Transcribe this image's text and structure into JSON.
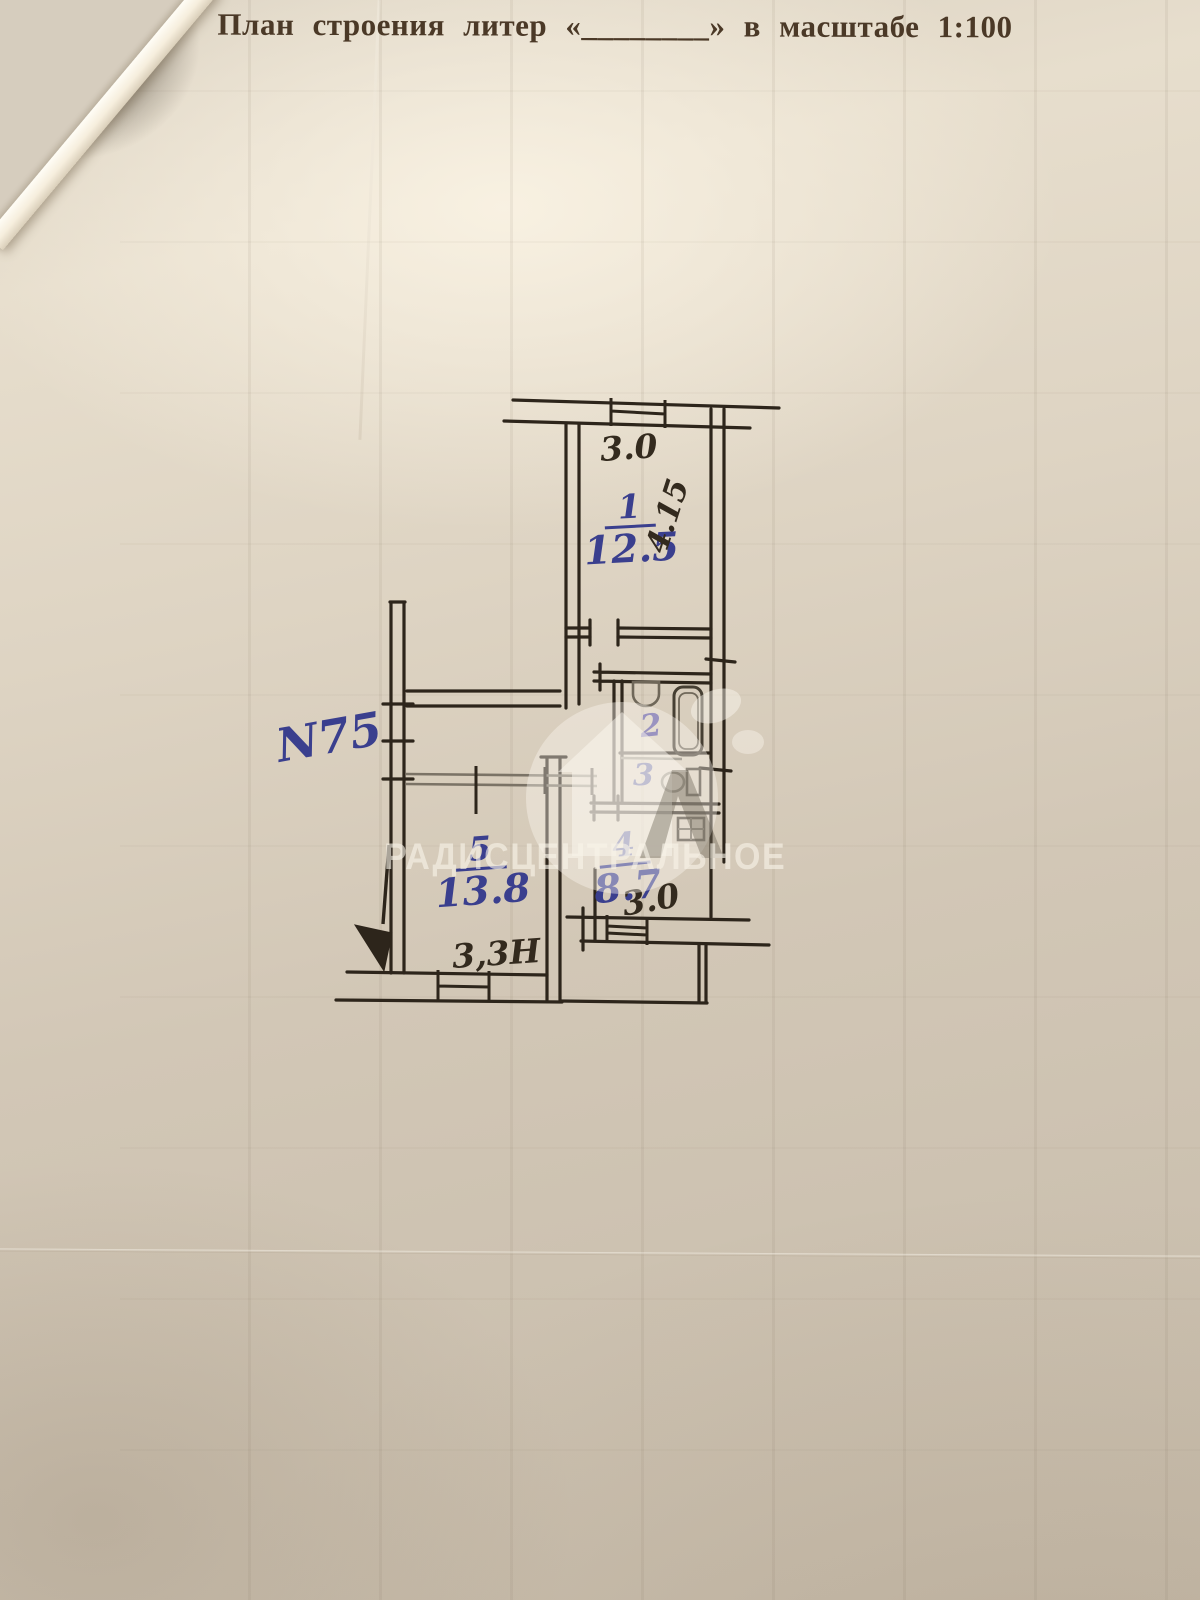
{
  "page": {
    "title": "План строения литер «________» в масштабе 1:100"
  },
  "plan": {
    "apartment_number": "N75",
    "rooms": [
      {
        "number": "1",
        "area": "12.5"
      },
      {
        "number": "2"
      },
      {
        "number": "3"
      },
      {
        "number": "4",
        "area": "8.7"
      },
      {
        "number": "5",
        "area": "13.8"
      }
    ],
    "dimensions": {
      "room1_width": "3.0",
      "room1_depth": "4.15",
      "kitchen_width": "3.0",
      "room5_width": "3,3Н"
    }
  },
  "watermark": {
    "text": "РАДИСЦЕНТРАЛЬНОЕ"
  },
  "colors": {
    "blue_ink": "#3a3f8e",
    "dark_ink": "#332a1e",
    "paper": "#cdc2b1"
  }
}
